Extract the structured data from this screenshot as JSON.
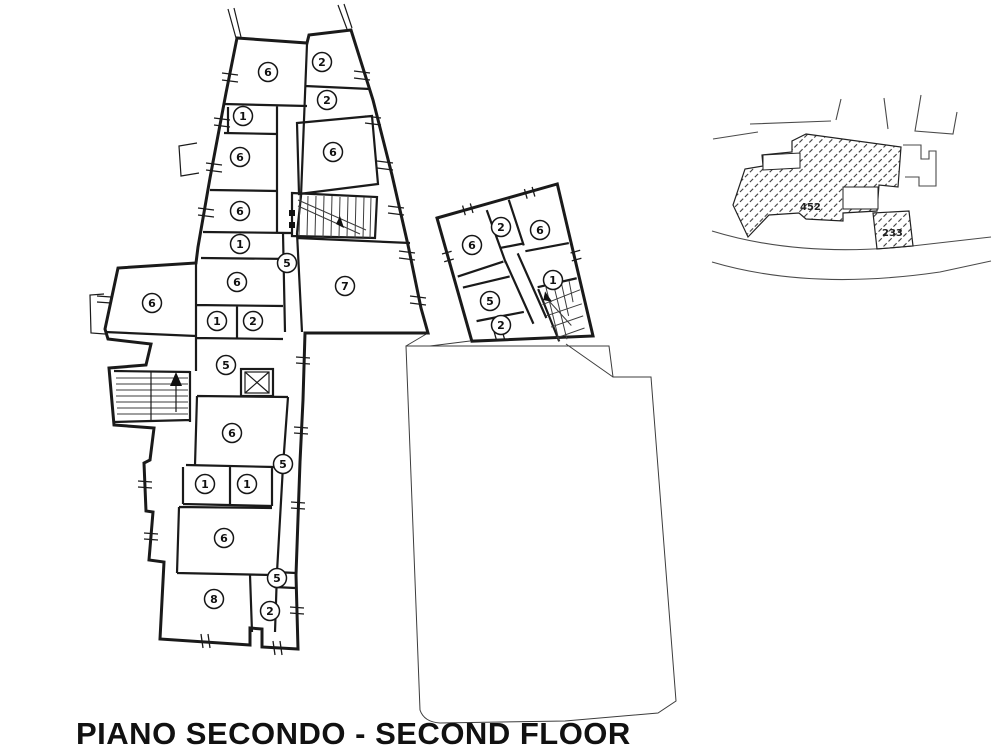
{
  "title": "PIANO SECONDO - SECOND FLOOR",
  "floor_plan": {
    "rooms": [
      {
        "label": "6",
        "x": 268,
        "y": 72
      },
      {
        "label": "2",
        "x": 322,
        "y": 62
      },
      {
        "label": "2",
        "x": 327,
        "y": 100
      },
      {
        "label": "1",
        "x": 243,
        "y": 116
      },
      {
        "label": "6",
        "x": 240,
        "y": 157
      },
      {
        "label": "6",
        "x": 333,
        "y": 152
      },
      {
        "label": "6",
        "x": 240,
        "y": 211
      },
      {
        "label": "1",
        "x": 240,
        "y": 244
      },
      {
        "label": "5",
        "x": 287,
        "y": 263
      },
      {
        "label": "6",
        "x": 237,
        "y": 282
      },
      {
        "label": "7",
        "x": 345,
        "y": 286
      },
      {
        "label": "6",
        "x": 152,
        "y": 303
      },
      {
        "label": "1",
        "x": 217,
        "y": 321
      },
      {
        "label": "2",
        "x": 253,
        "y": 321
      },
      {
        "label": "5",
        "x": 226,
        "y": 365
      },
      {
        "label": "6",
        "x": 232,
        "y": 433
      },
      {
        "label": "5",
        "x": 283,
        "y": 464
      },
      {
        "label": "1",
        "x": 205,
        "y": 484
      },
      {
        "label": "1",
        "x": 247,
        "y": 484
      },
      {
        "label": "6",
        "x": 224,
        "y": 538
      },
      {
        "label": "5",
        "x": 277,
        "y": 578
      },
      {
        "label": "8",
        "x": 214,
        "y": 599
      },
      {
        "label": "2",
        "x": 270,
        "y": 611
      },
      {
        "label": "6",
        "x": 472,
        "y": 245
      },
      {
        "label": "2",
        "x": 501,
        "y": 227
      },
      {
        "label": "6",
        "x": 540,
        "y": 230
      },
      {
        "label": "1",
        "x": 553,
        "y": 280
      },
      {
        "label": "5",
        "x": 490,
        "y": 301
      },
      {
        "label": "2",
        "x": 501,
        "y": 325
      }
    ],
    "features": {
      "stair_main": "staircase",
      "stair_west": "staircase-with-up-arrow",
      "stair_annex": "winder-staircase",
      "elevator": "elevator-shaft"
    }
  },
  "keymap": {
    "parcel_primary": "452",
    "parcel_secondary": "233"
  }
}
